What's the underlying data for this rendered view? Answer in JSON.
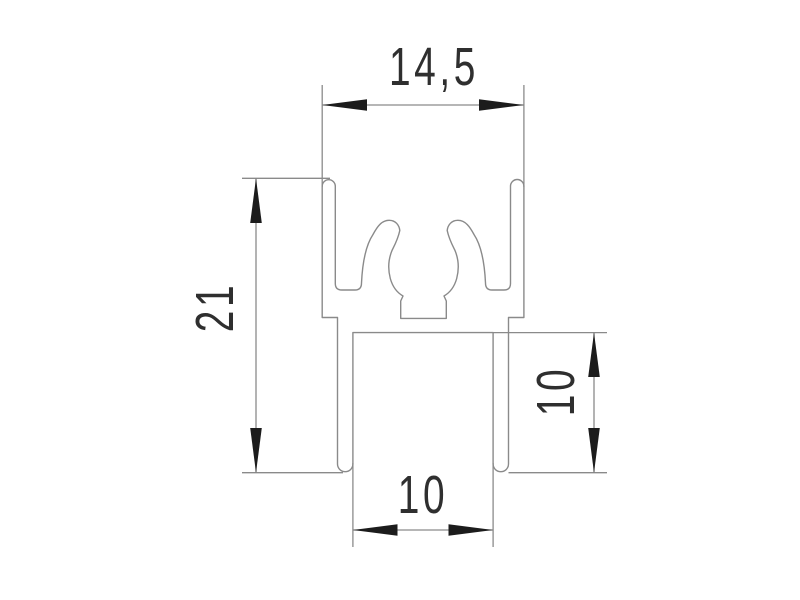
{
  "dimensions": {
    "top_width": "14,5",
    "left_height": "21",
    "right_height": "10",
    "bottom_width": "10"
  },
  "colors": {
    "background": "#ffffff",
    "line": "#8a8a8a",
    "arrow": "#1c1c1c",
    "text": "#2f2f2f"
  }
}
